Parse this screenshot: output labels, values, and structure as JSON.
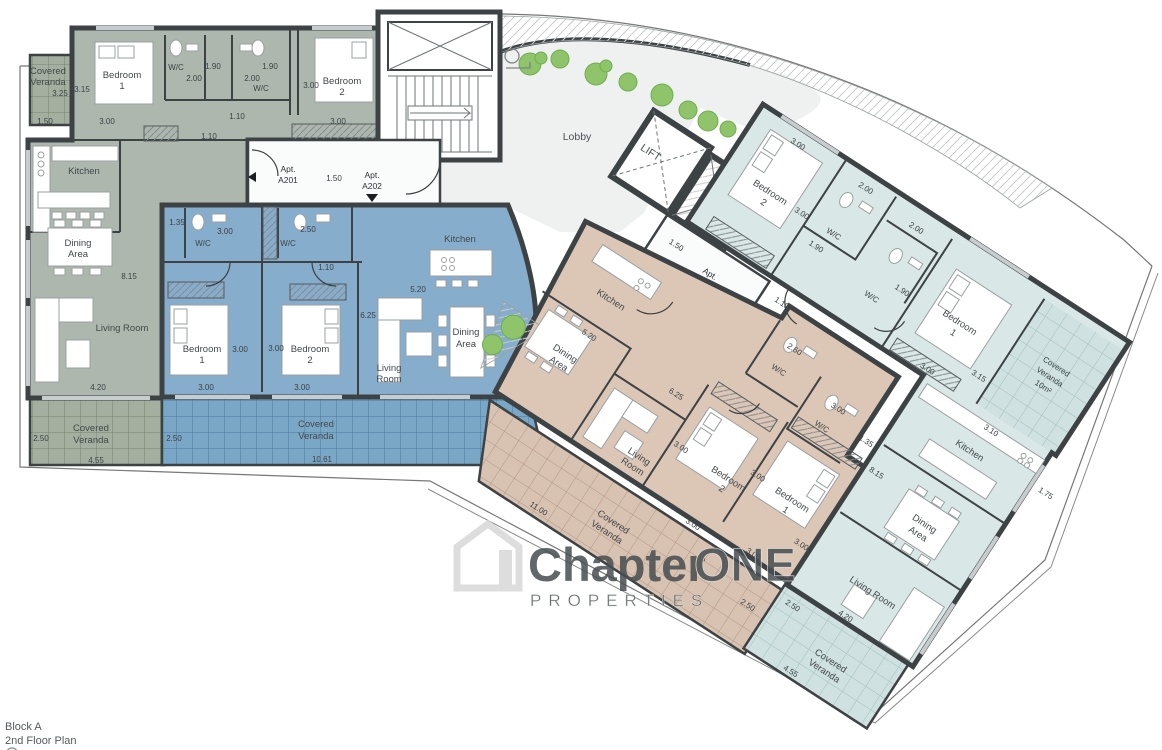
{
  "title_block": {
    "line1": "Block A",
    "line2": "2nd Floor Plan"
  },
  "watermark": {
    "part1": "Chapter",
    "part2": "ONE",
    "part3": "PROPERTIES"
  },
  "colors": {
    "a201": "#adb7ae",
    "a201_veranda": "#a4afa0",
    "a202": "#86adcb",
    "a202_veranda": "#7ba7c6",
    "a203": "#dcc7b6",
    "a203_veranda": "#d8c2b1",
    "a204": "#d9e7e6",
    "a204_veranda": "#cfe1e0",
    "wall": "#3d4245",
    "lobby": "#eff1f1",
    "plant": "#7db95a"
  },
  "core": {
    "lobby": "Lobby",
    "lift": "LIFT",
    "entry_a": {
      "apt1": "Apt. A201",
      "dim": "1.50",
      "apt2": "Apt. A202"
    },
    "entry_b": {
      "dim": "1.50",
      "apt1": "Apt. A203",
      "apt2": "Apt. A204",
      "dim_b1": "1.10",
      "dim_b2": "1.10"
    }
  },
  "a201": {
    "veranda_top": {
      "label": "Covered Veranda",
      "d1": "3.25",
      "d2": "1.50"
    },
    "bedroom1": {
      "label": "Bedroom 1",
      "d1": "3.15",
      "d2": "3.00"
    },
    "wc1": {
      "label": "W/C",
      "d1": "2.00",
      "d2": "1.90"
    },
    "wc2": {
      "label": "W/C",
      "d1": "2.00",
      "d2": "1.90"
    },
    "bedroom2": {
      "label": "Bedroom 2",
      "d1": "3.00",
      "d2": "3.00"
    },
    "hall": {
      "d1": "1.10",
      "d2": "1.10"
    },
    "kitchen": {
      "label": "Kitchen"
    },
    "dining": {
      "label": "Dining Area",
      "d1": "8.15"
    },
    "living": {
      "label": "Living Room",
      "d1": "4.20"
    },
    "veranda": {
      "label": "Covered Veranda",
      "d1": "2.50",
      "d2": "4.55"
    }
  },
  "a202": {
    "wc1": {
      "label": "W/C",
      "d1": "1.35",
      "d2": "3.00"
    },
    "wc2": {
      "label": "W/C",
      "d1": "2.50"
    },
    "hall": {
      "d1": "1.10"
    },
    "bedroom1": {
      "label": "Bedroom 1",
      "d1": "3.00",
      "d2": "3.00"
    },
    "bedroom2": {
      "label": "Bedroom 2",
      "d1": "3.00",
      "d2": "3.00"
    },
    "kitchen": {
      "label": "Kitchen",
      "d1": "5.20"
    },
    "living": {
      "label": "Living Room",
      "d1": "6.25"
    },
    "dining": {
      "label": "Dining Area"
    },
    "veranda": {
      "label": "Covered Veranda",
      "d1": "2.50",
      "d2": "10.61"
    }
  },
  "a203": {
    "kitchen": {
      "label": "Kitchen",
      "d1": "5.20"
    },
    "dining": {
      "label": "Dining Area"
    },
    "living": {
      "label": "Living Room",
      "d1": "6.25"
    },
    "wc1": {
      "label": "W/C",
      "d1": "2.60"
    },
    "wc2": {
      "label": "W/C",
      "d1": "3.00",
      "d2": "1.35"
    },
    "bedroom2": {
      "label": "Bedroom 2",
      "d1": "3.00",
      "d2": "3.00"
    },
    "bedroom1": {
      "label": "Bedroom 1",
      "d1": "3.00",
      "d2": "3.00",
      "d3": "3.00"
    },
    "veranda": {
      "label": "Covered Veranda",
      "d1": "11.00",
      "d2": "2.50"
    }
  },
  "a204": {
    "bedroom2": {
      "label": "Bedroom 2",
      "d1": "3.00",
      "d2": "3.00"
    },
    "wc1": {
      "label": "W/C",
      "d1": "2.00",
      "d2": "1.90"
    },
    "wc2": {
      "label": "W/C",
      "d1": "2.00",
      "d2": "1.90"
    },
    "bedroom1": {
      "label": "Bedroom 1",
      "d1": "3.15",
      "d2": "3.00"
    },
    "veranda_top": {
      "label": "Covered Veranda 10m²",
      "d1": "3.10"
    },
    "kitchen": {
      "label": "Kitchen",
      "d1": "1.75"
    },
    "dining": {
      "label": "Dining Area",
      "d1": "8.15"
    },
    "living": {
      "label": "Living Room",
      "d1": "4.20"
    },
    "veranda": {
      "label": "Covered Veranda",
      "d1": "2.50",
      "d2": "4.55"
    }
  }
}
